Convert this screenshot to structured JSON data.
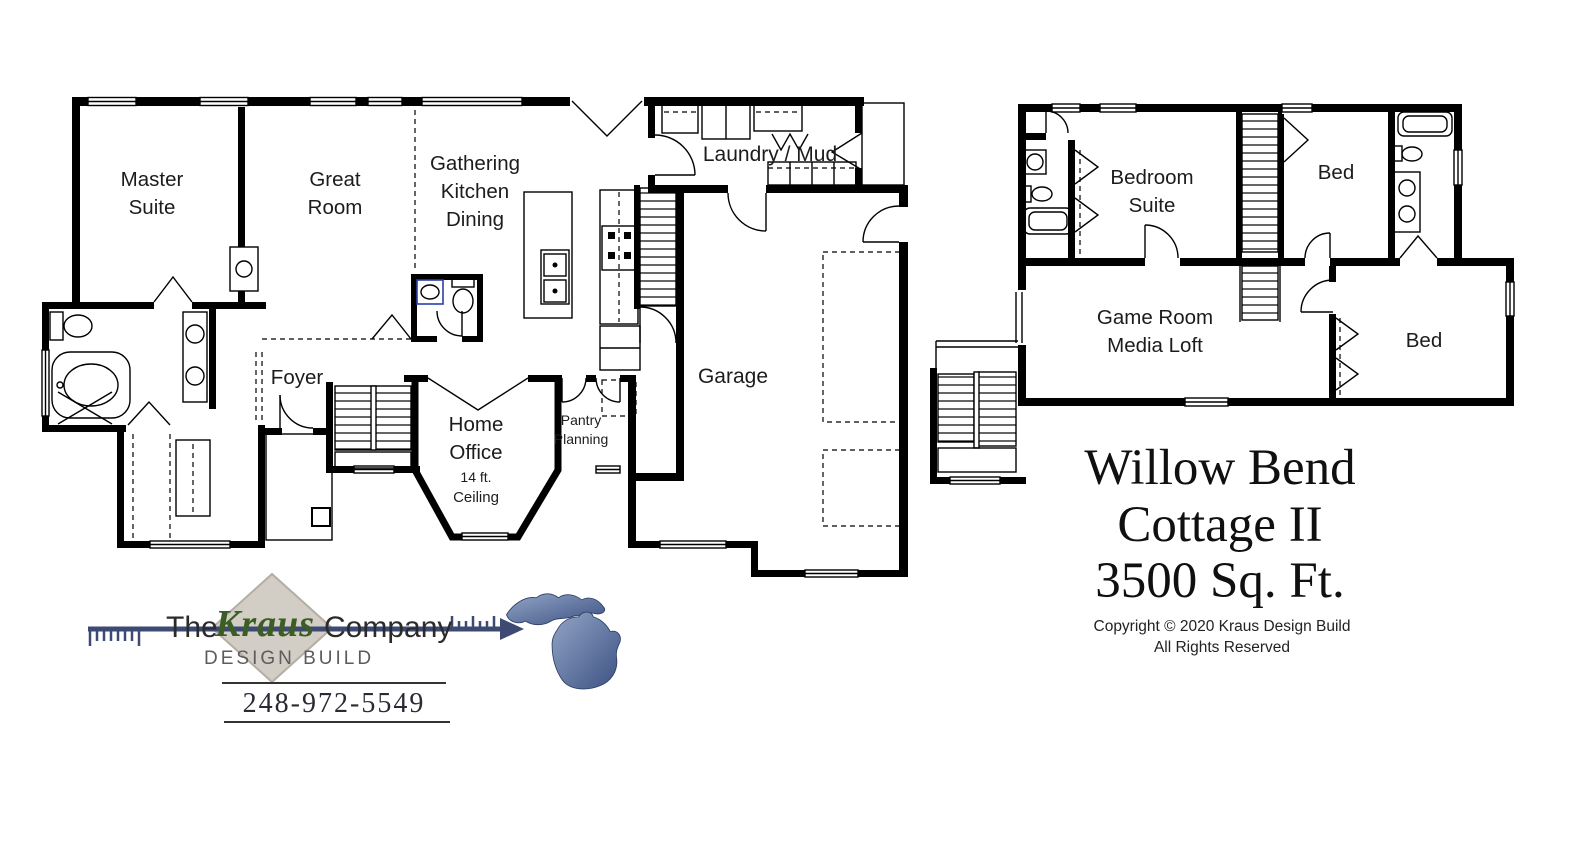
{
  "page": {
    "background": "#ffffff"
  },
  "title_block": {
    "line1": "Willow Bend",
    "line2": "Cottage II",
    "line3": "3500 Sq. Ft.",
    "copyright_line1": "Copyright © 2020 Kraus Design Build",
    "copyright_line2": "All Rights Reserved"
  },
  "branding": {
    "prefix": "The",
    "brand": "Kraus",
    "suffix": "Company",
    "tagline": "DESIGN BUILD",
    "phone": "248-972-5549",
    "colors": {
      "brand_green": "#3c5e24",
      "arrow_navy": "#3d4a73",
      "diamond_gray": "#d2cdc5",
      "diamond_edge": "#b3ada3",
      "michigan_light": "#93a5c6",
      "michigan_dark": "#3c5183",
      "plan_ink": "#000000"
    }
  },
  "plans": {
    "main_floor": {
      "master_suite_1": "Master",
      "master_suite_2": "Suite",
      "great_room_1": "Great",
      "great_room_2": "Room",
      "kitchen_1": "Gathering",
      "kitchen_2": "Kitchen",
      "kitchen_3": "Dining",
      "laundry": "Laundry / Mud",
      "garage": "Garage",
      "foyer": "Foyer",
      "home_office_1": "Home",
      "home_office_2": "Office",
      "home_office_note_1": "14 ft.",
      "home_office_note_2": "Ceiling",
      "pantry_1": "Pantry",
      "pantry_2": "Planning"
    },
    "upper_floor": {
      "bedroom_suite_1": "Bedroom",
      "bedroom_suite_2": "Suite",
      "bed_front": "Bed",
      "game_room_1": "Game Room",
      "game_room_2": "Media Loft",
      "bed_rear": "Bed"
    }
  }
}
